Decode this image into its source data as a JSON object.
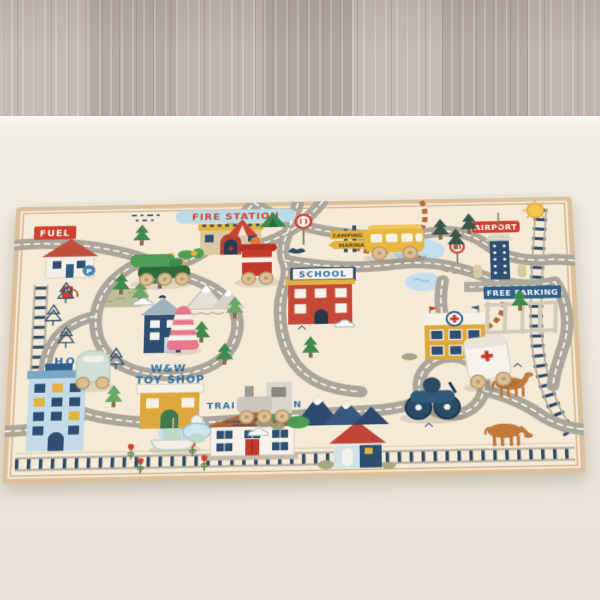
{
  "environment": {
    "floor": "gray-wood-plank-floor",
    "floor_color": "#bdb2a9",
    "carpet_color": "#eee9dc"
  },
  "rug": {
    "labels": {
      "fuel": "FUEL",
      "fire_station": "FIRE STATION",
      "airport": "AIRPORT",
      "school": "SCHOOL",
      "free_parking": "FREE PARKING",
      "hotel": "HOTEL",
      "toyshop_line1": "W&W",
      "toyshop_line2": "TOY SHOP",
      "train_station": "TRAIN STATION",
      "camping": "CAMPING",
      "marina": "MARINA",
      "p_sign": "P"
    },
    "colors": {
      "rug_base": "#f5ead6",
      "rug_binding": "#dcc09c",
      "road": "#aba699",
      "road_dash": "#fcf8ef",
      "rail_tie": "#2e4a66",
      "rail_rail": "#b3ab9d",
      "label_blue": "#2f6da5",
      "label_red": "#d0452f",
      "sign_red": "#cf4030",
      "banner_blue": "#bcdbe8",
      "building_red": "#c54936",
      "building_mustard": "#dfa83c",
      "building_lightblue": "#c3dbe9",
      "building_navy": "#2e4e72",
      "tree_green": "#3f8a4c",
      "trail_brown": "#b06a3a",
      "horse_brown": "#c07a3e",
      "pond_blue": "#c5dff0",
      "mountain_navy": "#2b4a6e"
    }
  },
  "toys": [
    {
      "name": "green-car",
      "color": "#4f9e55"
    },
    {
      "name": "red-train",
      "color": "#c5392c"
    },
    {
      "name": "yellow-school-bus",
      "color": "#e8b73f"
    },
    {
      "name": "pink-striped-cone",
      "color": "#e8788a"
    },
    {
      "name": "mint-car",
      "color": "#cfe0d4"
    },
    {
      "name": "gray-train-engine",
      "color": "#c9c6be"
    },
    {
      "name": "boat-and-spinning-top",
      "color": "#cfe4ef"
    },
    {
      "name": "navy-motorcycle",
      "color": "#2b4a66"
    },
    {
      "name": "white-ambulance",
      "color": "#f6f3ec"
    }
  ]
}
